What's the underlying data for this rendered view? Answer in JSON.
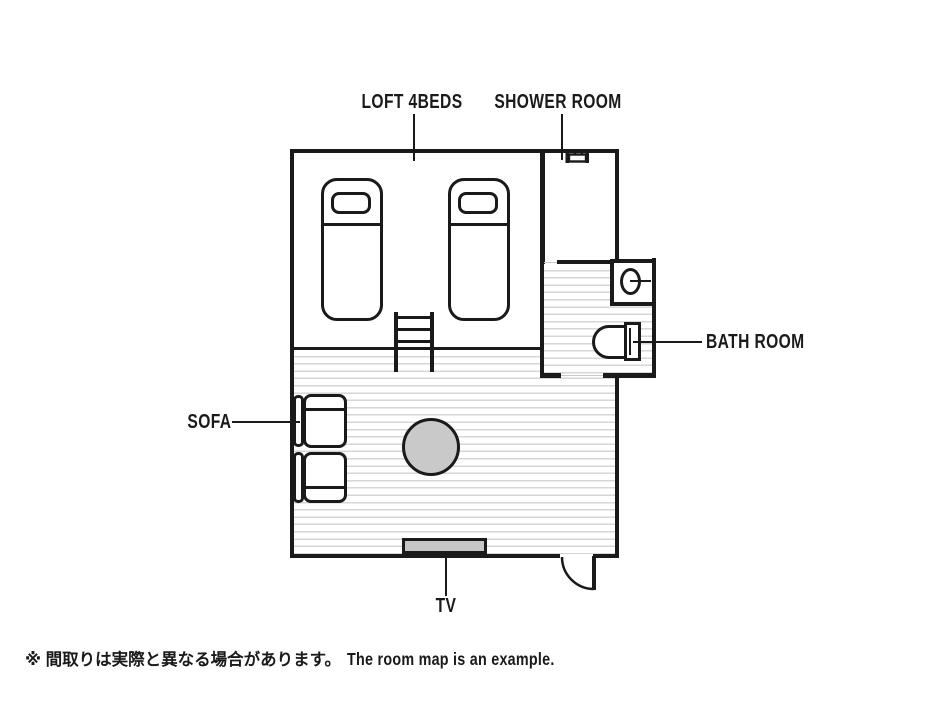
{
  "title": "room-floor-plan",
  "labels": {
    "loft": "LOFT 4BEDS",
    "shower": "SHOWER ROOM",
    "bath": "BATH ROOM",
    "sofa": "SOFA",
    "tv": "TV"
  },
  "footer": {
    "note_jp": "※ 間取りは実際と異なる場合があります。",
    "note_en": "The room map is an example."
  },
  "fixtures": [
    "bed",
    "bed",
    "ladder",
    "shower-head",
    "wash-basin",
    "toilet",
    "sofa",
    "round-table",
    "tv",
    "entry-door"
  ],
  "colors": {
    "line": "#1a1a1a",
    "stripe": "#d6d6d6",
    "table_fill": "#c9c9c9",
    "tv_fill": "#c6c6c6",
    "threshold": "#c9c9c9"
  }
}
